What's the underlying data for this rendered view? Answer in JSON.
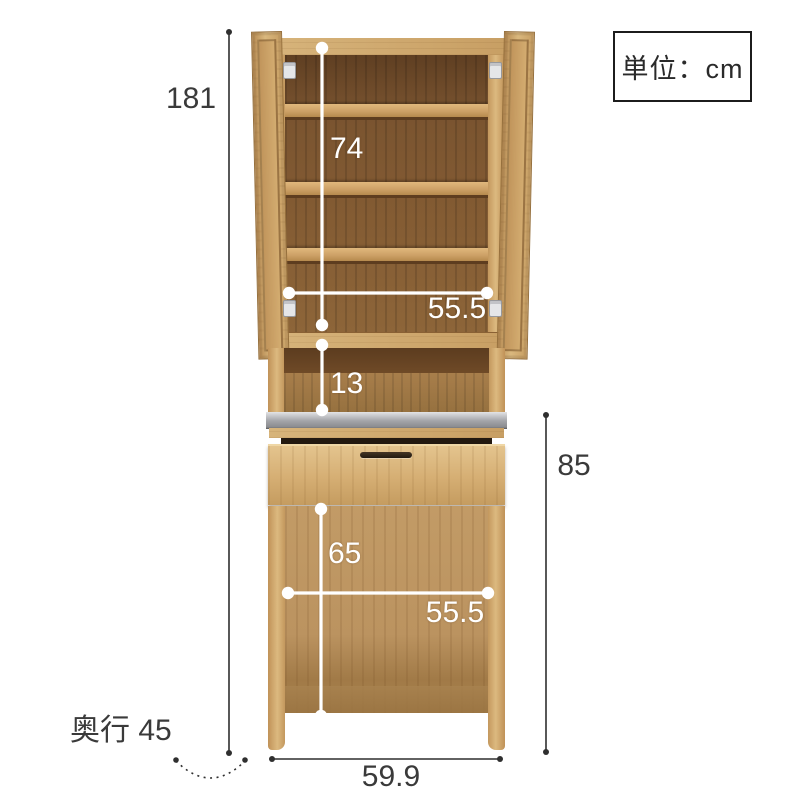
{
  "unit_box": {
    "label": "単位：cm"
  },
  "dimensions": {
    "overall_height": "181",
    "upper_interior_height": "74",
    "upper_interior_width": "55.5",
    "counter_niche_height": "13",
    "lower_section_height": "85",
    "lower_interior_height": "65",
    "lower_interior_width": "55.5",
    "overall_width": "59.9",
    "depth_label": "奥行 45"
  },
  "colors": {
    "wood_light": "#d2ab71",
    "wood_interior_dark": "#7c5530",
    "wood_interior_light": "#bb9360",
    "countertop_gray": "#a4a5a9",
    "dimension_line_black": "#2f2f2f",
    "dimension_line_white": "#ffffff",
    "text": "#3a3a3a"
  }
}
